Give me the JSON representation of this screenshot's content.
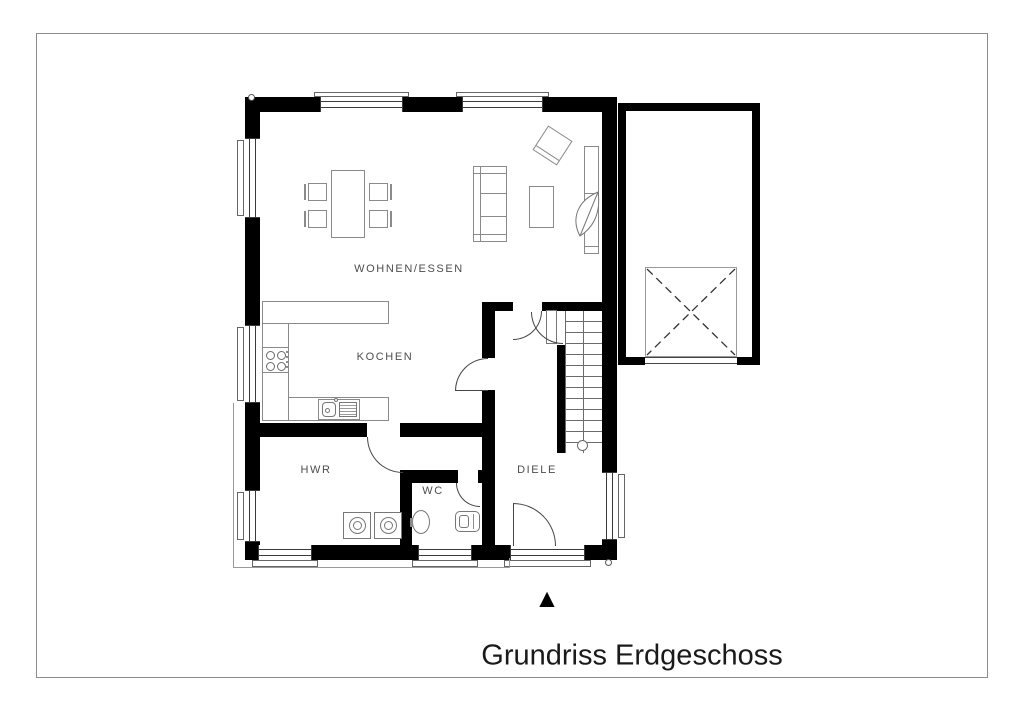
{
  "document": {
    "title": "Grundriss Erdgeschoss"
  },
  "rooms": [
    {
      "name": "WOHNEN/ESSEN"
    },
    {
      "name": "KOCHEN"
    },
    {
      "name": "HWR"
    },
    {
      "name": "WC"
    },
    {
      "name": "DIELE"
    }
  ],
  "compass": {
    "glyph": "▲"
  },
  "colors": {
    "wall": "#000000",
    "furniture_line": "#8a8a8a",
    "window_line": "#3a3a3a",
    "room_label": "#4d4d4d",
    "title_text": "#1a1a1a",
    "sheet_border": "#8c8c8c"
  }
}
